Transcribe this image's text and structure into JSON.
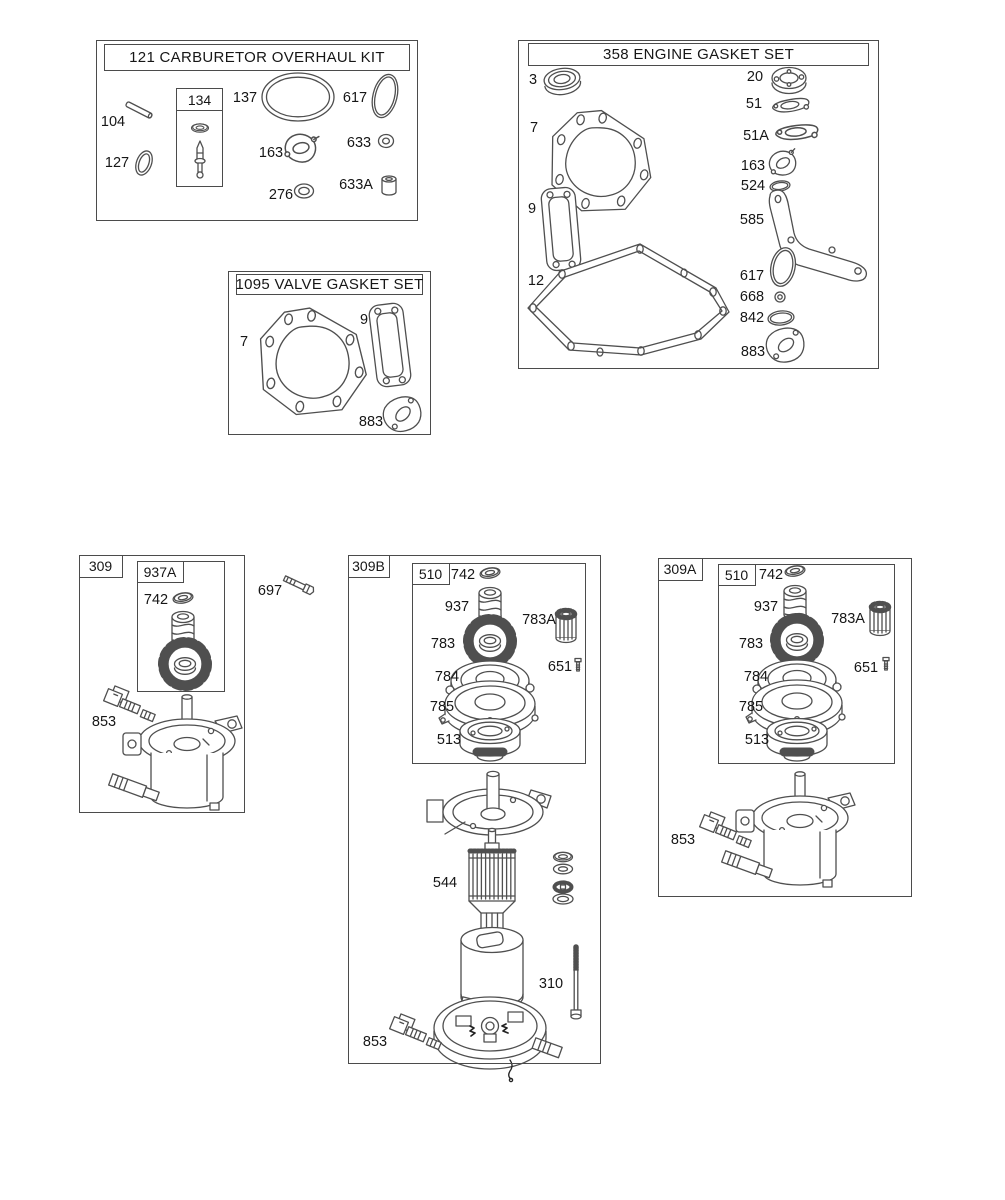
{
  "colors": {
    "line": "#4f4f4f",
    "text": "#161616",
    "background": "#ffffff"
  },
  "sections": {
    "carb_kit": {
      "title": "121 CARBURETOR OVERHAUL KIT",
      "needle_kit_label": "134",
      "parts": {
        "p104": "104",
        "p127": "127",
        "p137": "137",
        "p617": "617",
        "p163": "163",
        "p633": "633",
        "p276": "276",
        "p633a": "633A"
      }
    },
    "engine_gasket_set": {
      "title": "358 ENGINE GASKET SET",
      "parts": {
        "p3": "3",
        "p7": "7",
        "p9": "9",
        "p12": "12",
        "p20": "20",
        "p51": "51",
        "p51a": "51A",
        "p163": "163",
        "p524": "524",
        "p585": "585",
        "p617": "617",
        "p668": "668",
        "p842": "842",
        "p883": "883"
      }
    },
    "valve_gasket_set": {
      "title": "1095 VALVE GASKET SET",
      "parts": {
        "p7": "7",
        "p9": "9",
        "p883": "883"
      }
    },
    "starter_309": {
      "label": "309",
      "drive_kit_label": "937A",
      "parts": {
        "p742": "742",
        "p853": "853"
      },
      "loose_parts": {
        "p697": "697"
      }
    },
    "starter_309b": {
      "label": "309B",
      "drive_kit_label": "510",
      "kit_parts": {
        "p742": "742",
        "p937": "937",
        "p783a": "783A",
        "p783": "783",
        "p651": "651",
        "p784": "784",
        "p785": "785",
        "p513": "513"
      },
      "parts": {
        "p544": "544",
        "p310": "310",
        "p853": "853"
      }
    },
    "starter_309a": {
      "label": "309A",
      "drive_kit_label": "510",
      "kit_parts": {
        "p742": "742",
        "p937": "937",
        "p783a": "783A",
        "p783": "783",
        "p651": "651",
        "p784": "784",
        "p785": "785",
        "p513": "513"
      },
      "parts": {
        "p853": "853"
      }
    }
  }
}
